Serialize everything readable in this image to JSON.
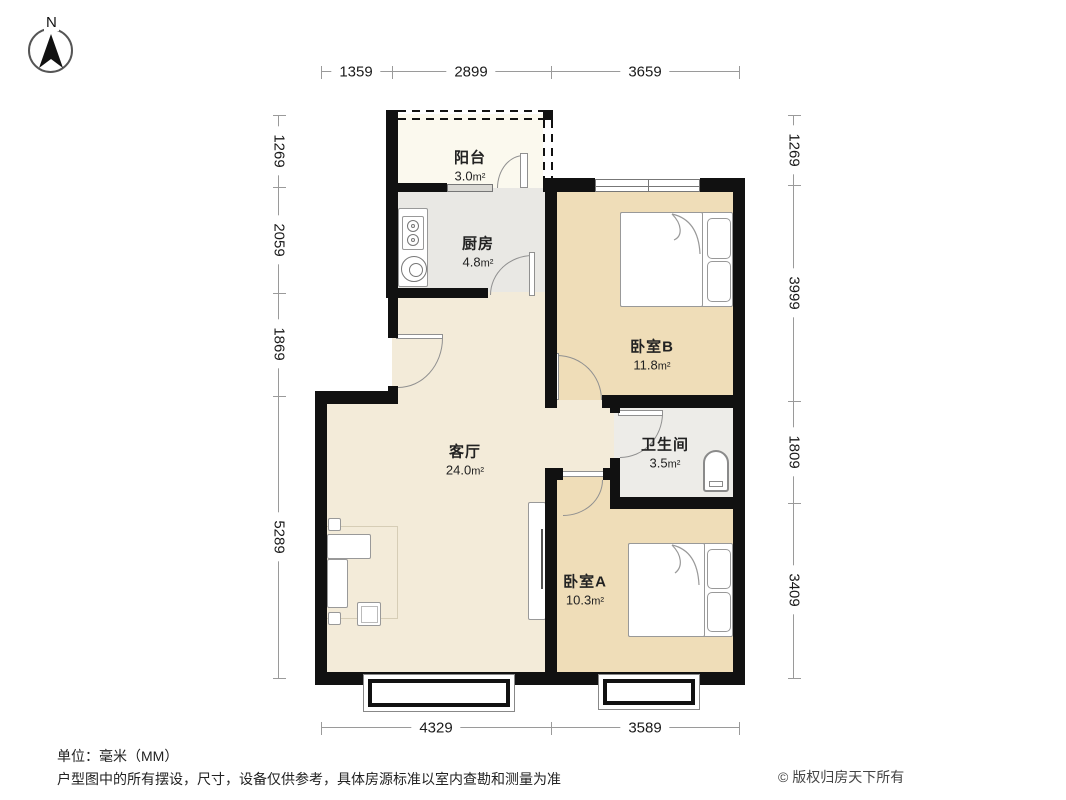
{
  "compass": {
    "label": "N"
  },
  "rooms": [
    {
      "id": "balcony",
      "name": "阳台",
      "area_value": "3.0",
      "area_unit": "m²"
    },
    {
      "id": "kitchen",
      "name": "厨房",
      "area_value": "4.8",
      "area_unit": "m²"
    },
    {
      "id": "bedroom-b",
      "name": "卧室B",
      "area_value": "11.8",
      "area_unit": "m²"
    },
    {
      "id": "living",
      "name": "客厅",
      "area_value": "24.0",
      "area_unit": "m²"
    },
    {
      "id": "bathroom",
      "name": "卫生间",
      "area_value": "3.5",
      "area_unit": "m²"
    },
    {
      "id": "bedroom-a",
      "name": "卧室A",
      "area_value": "10.3",
      "area_unit": "m²"
    }
  ],
  "dimensions": {
    "top": [
      "1359",
      "2899",
      "3659"
    ],
    "bottom": [
      "4329",
      "3589"
    ],
    "left": [
      "1269",
      "2059",
      "1869",
      "5289"
    ],
    "right": [
      "1269",
      "3999",
      "1809",
      "3409"
    ]
  },
  "footer": {
    "unit_note": "单位：毫米（MM）",
    "disclaimer": "户型图中的所有摆设，尺寸，设备仅供参考，具体房源标准以室内查勘和测量为准",
    "copyright": "© 版权归房天下所有"
  },
  "watermark": {
    "text": "房天下 fang.com"
  },
  "colors": {
    "wall": "#111111",
    "living_floor": "#F3EBD9",
    "bedroom_floor": "#EFDDB8",
    "kitchen_floor": "#E9E8E4",
    "bathroom_floor": "#EDECE8",
    "balcony_floor": "#FBF9EE",
    "dimension_line": "#9A9A9A"
  }
}
